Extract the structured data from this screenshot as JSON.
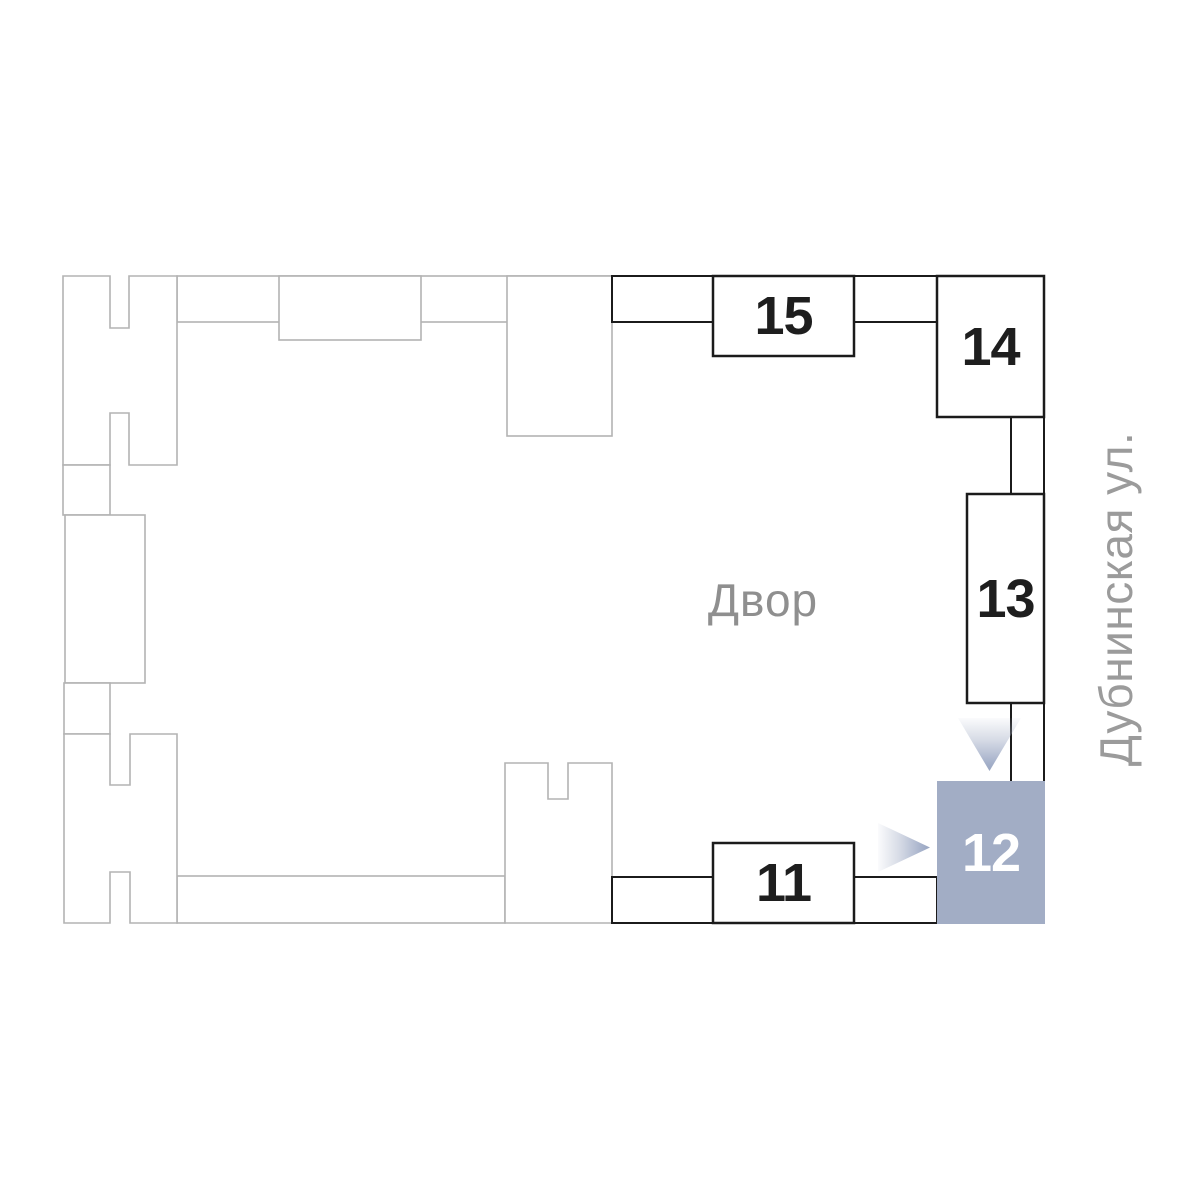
{
  "plan": {
    "courtyard_label": "Двор",
    "street_label": "Дубнинская ул.",
    "buildings": [
      {
        "number": "15",
        "selected": false
      },
      {
        "number": "14",
        "selected": false
      },
      {
        "number": "13",
        "selected": false
      },
      {
        "number": "12",
        "selected": true
      },
      {
        "number": "11",
        "selected": false
      }
    ],
    "colors": {
      "highlight_fill": "#a2adc5",
      "number_dark": "#1e1e1e",
      "number_on_highlight": "#ffffff",
      "active_outline": "#1b1b1b",
      "inactive_outline": "#b3b3b3",
      "courtyard_text": "#8f8f8f",
      "street_text": "#9b9b9b"
    }
  }
}
